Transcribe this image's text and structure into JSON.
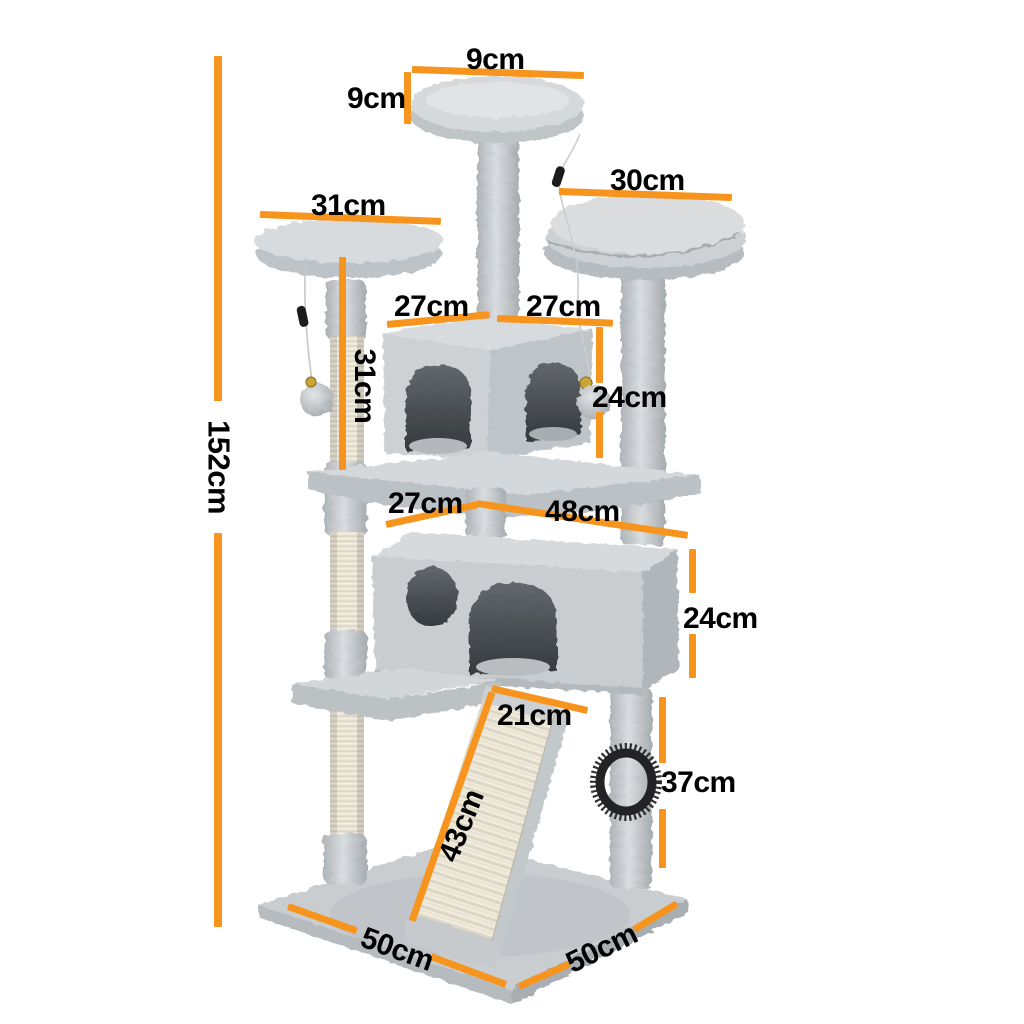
{
  "diagram": {
    "title": "cat tree dimension diagram",
    "unit": "cm",
    "accent_color": "#f7941e",
    "text_color": "#000000",
    "background_color": "#ffffff",
    "annotations": {
      "total_height": "152cm",
      "top_platform_width": "9cm",
      "top_platform_thickness": "9cm",
      "right_platform_width": "30cm",
      "left_platform_width": "31cm",
      "left_post_height": "31cm",
      "top_condo_left_width": "27cm",
      "top_condo_right_width": "27cm",
      "top_condo_height": "24cm",
      "mid_platform_depth": "27cm",
      "mid_platform_width": "48cm",
      "lower_condo_height": "24cm",
      "ramp_width": "21cm",
      "ramp_length": "43cm",
      "rear_post_height": "37cm",
      "base_depth": "50cm",
      "base_width": "50cm"
    }
  }
}
